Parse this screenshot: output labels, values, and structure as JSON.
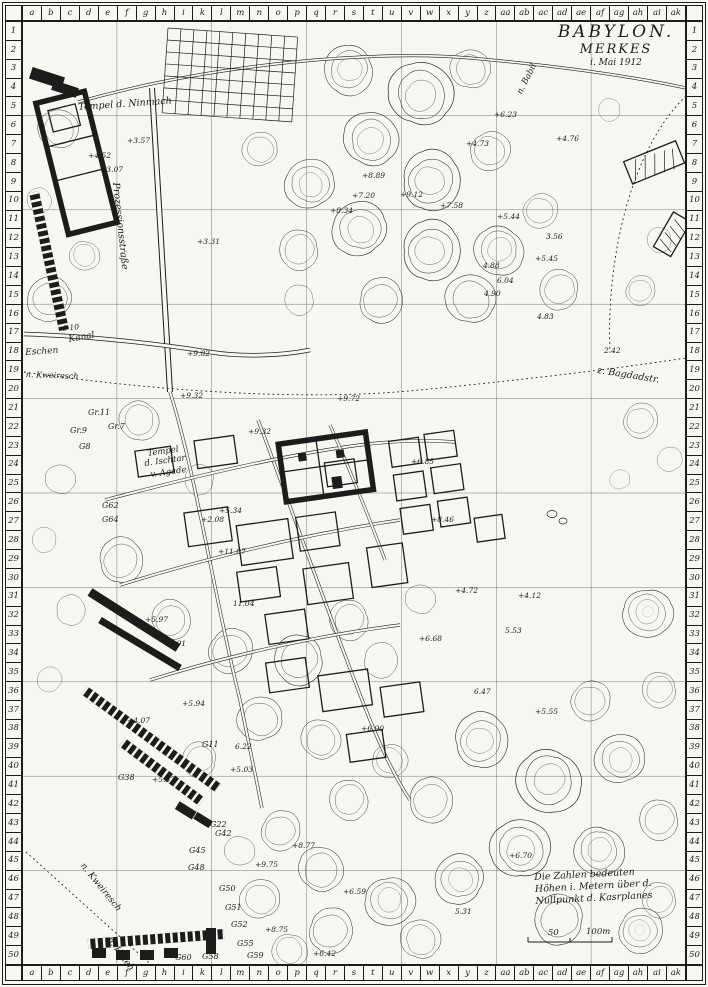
{
  "title": {
    "line1": "BABYLON.",
    "line2": "MERKES",
    "line3": "i. Mai 1912"
  },
  "legend": {
    "line1": "Die Zahlen bedeuten",
    "line2": "Höhen i. Metern über d.",
    "line3": "Nullpunkt d. Kasrplanes"
  },
  "scale": {
    "mid": "50",
    "end": "100m"
  },
  "grid": {
    "columns": [
      "a",
      "b",
      "c",
      "d",
      "e",
      "f",
      "g",
      "h",
      "i",
      "k",
      "l",
      "m",
      "n",
      "o",
      "p",
      "q",
      "r",
      "s",
      "t",
      "u",
      "v",
      "w",
      "x",
      "y",
      "z",
      "aa",
      "ab",
      "ac",
      "ad",
      "ae",
      "af",
      "ag",
      "ah",
      "ai",
      "ak"
    ],
    "rows": [
      "1",
      "2",
      "3",
      "4",
      "5",
      "6",
      "7",
      "8",
      "9",
      "10",
      "11",
      "12",
      "13",
      "14",
      "15",
      "16",
      "17",
      "18",
      "19",
      "20",
      "21",
      "22",
      "23",
      "24",
      "25",
      "26",
      "27",
      "28",
      "29",
      "30",
      "31",
      "32",
      "33",
      "34",
      "35",
      "36",
      "37",
      "38",
      "39",
      "40",
      "41",
      "42",
      "43",
      "44",
      "45",
      "46",
      "47",
      "48",
      "49",
      "50"
    ]
  },
  "map": {
    "labels": [
      {
        "text": "Tempel d. Ninmach",
        "x": 78,
        "y": 103,
        "rotate": -4,
        "size": 9.5
      },
      {
        "text": "Prozessionsstraße",
        "x": 120,
        "y": 182,
        "rotate": 84,
        "size": 9.5
      },
      {
        "text": "6·10",
        "x": 62,
        "y": 325,
        "rotate": -6,
        "size": 7.5
      },
      {
        "text": "Kanal",
        "x": 68,
        "y": 336,
        "rotate": -10,
        "size": 9
      },
      {
        "text": "Eschen",
        "x": 25,
        "y": 349,
        "rotate": -4,
        "size": 9
      },
      {
        "text": "n. Kweiresch",
        "x": 26,
        "y": 371,
        "rotate": 2,
        "size": 8
      },
      {
        "text": "Tempel",
        "x": 147,
        "y": 450,
        "rotate": -8,
        "size": 8.5
      },
      {
        "text": "d. Ischtar",
        "x": 144,
        "y": 460,
        "rotate": -8,
        "size": 8.5
      },
      {
        "text": "v. Agade",
        "x": 150,
        "y": 471,
        "rotate": -8,
        "size": 8.5
      },
      {
        "text": "z. Bagdadstr.",
        "x": 598,
        "y": 366,
        "rotate": 9,
        "size": 9.5
      },
      {
        "text": "n. Babil",
        "x": 516,
        "y": 92,
        "rotate": -63,
        "size": 8.5
      },
      {
        "text": "n. Kweiresch",
        "x": 85,
        "y": 862,
        "rotate": 51,
        "size": 9
      },
      {
        "text": "n. Hilleh",
        "x": 112,
        "y": 936,
        "rotate": 54,
        "size": 9
      }
    ],
    "spot_heights": [
      {
        "text": "+6.23",
        "x": 494,
        "y": 111
      },
      {
        "text": "+3.57",
        "x": 127,
        "y": 137
      },
      {
        "text": "+4.52",
        "x": 88,
        "y": 152
      },
      {
        "text": "+3.07",
        "x": 100,
        "y": 166
      },
      {
        "text": "+4.73",
        "x": 466,
        "y": 140
      },
      {
        "text": "+4.76",
        "x": 556,
        "y": 135
      },
      {
        "text": "+8.89",
        "x": 362,
        "y": 172
      },
      {
        "text": "+7.20",
        "x": 352,
        "y": 192
      },
      {
        "text": "+9.12",
        "x": 400,
        "y": 191
      },
      {
        "text": "+7.58",
        "x": 440,
        "y": 202
      },
      {
        "text": "+8.34",
        "x": 330,
        "y": 207
      },
      {
        "text": "+5.44",
        "x": 497,
        "y": 213
      },
      {
        "text": "+3.31",
        "x": 197,
        "y": 238
      },
      {
        "text": "3.56",
        "x": 546,
        "y": 233
      },
      {
        "text": "+5.45",
        "x": 535,
        "y": 255
      },
      {
        "text": "4.88",
        "x": 483,
        "y": 262
      },
      {
        "text": "6.04",
        "x": 497,
        "y": 277
      },
      {
        "text": "4.90",
        "x": 484,
        "y": 290
      },
      {
        "text": "4.83",
        "x": 537,
        "y": 313
      },
      {
        "text": "2.42",
        "x": 604,
        "y": 347
      },
      {
        "text": "+9.82",
        "x": 187,
        "y": 350
      },
      {
        "text": "+9.32",
        "x": 180,
        "y": 392
      },
      {
        "text": "+9.72",
        "x": 337,
        "y": 395
      },
      {
        "text": "+9.32",
        "x": 248,
        "y": 428
      },
      {
        "text": "+6.85",
        "x": 411,
        "y": 458
      },
      {
        "text": "+8.46",
        "x": 431,
        "y": 516
      },
      {
        "text": "+5.34",
        "x": 219,
        "y": 507
      },
      {
        "text": "+2.08",
        "x": 201,
        "y": 516
      },
      {
        "text": "+11.07",
        "x": 218,
        "y": 548
      },
      {
        "text": "11.04",
        "x": 233,
        "y": 600
      },
      {
        "text": "+5.97",
        "x": 145,
        "y": 616
      },
      {
        "text": "+6.91",
        "x": 163,
        "y": 640
      },
      {
        "text": "+4.72",
        "x": 455,
        "y": 587
      },
      {
        "text": "+4.12",
        "x": 518,
        "y": 592
      },
      {
        "text": "5.53",
        "x": 505,
        "y": 627
      },
      {
        "text": "+6.68",
        "x": 419,
        "y": 635
      },
      {
        "text": "6.47",
        "x": 474,
        "y": 688
      },
      {
        "text": "+5.55",
        "x": 535,
        "y": 708
      },
      {
        "text": "+6.90",
        "x": 361,
        "y": 725
      },
      {
        "text": "6.22",
        "x": 235,
        "y": 743
      },
      {
        "text": "+5.03",
        "x": 230,
        "y": 766
      },
      {
        "text": "+5.94",
        "x": 182,
        "y": 700
      },
      {
        "text": "+4.07",
        "x": 127,
        "y": 717
      },
      {
        "text": "+5.37",
        "x": 152,
        "y": 776
      },
      {
        "text": "+9.75",
        "x": 255,
        "y": 861
      },
      {
        "text": "+8.77",
        "x": 292,
        "y": 842
      },
      {
        "text": "+8.75",
        "x": 265,
        "y": 926
      },
      {
        "text": "+6.59",
        "x": 343,
        "y": 888
      },
      {
        "text": "5.31",
        "x": 455,
        "y": 908
      },
      {
        "text": "+6.70",
        "x": 509,
        "y": 852
      },
      {
        "text": "+6.42",
        "x": 313,
        "y": 950
      }
    ],
    "excavation_labels": [
      {
        "text": "Gr.11",
        "x": 88,
        "y": 409
      },
      {
        "text": "Gr.9",
        "x": 70,
        "y": 427
      },
      {
        "text": "Gr.7",
        "x": 108,
        "y": 423
      },
      {
        "text": "G8",
        "x": 79,
        "y": 443
      },
      {
        "text": "G62",
        "x": 102,
        "y": 502
      },
      {
        "text": "G64",
        "x": 102,
        "y": 516
      },
      {
        "text": "G11",
        "x": 202,
        "y": 741
      },
      {
        "text": "G38",
        "x": 118,
        "y": 774
      },
      {
        "text": "G22",
        "x": 210,
        "y": 821
      },
      {
        "text": "G42",
        "x": 215,
        "y": 830
      },
      {
        "text": "G45",
        "x": 189,
        "y": 847
      },
      {
        "text": "G48",
        "x": 188,
        "y": 864
      },
      {
        "text": "G50",
        "x": 219,
        "y": 885
      },
      {
        "text": "G51",
        "x": 225,
        "y": 904
      },
      {
        "text": "G52",
        "x": 231,
        "y": 921
      },
      {
        "text": "G55",
        "x": 237,
        "y": 940
      },
      {
        "text": "G58",
        "x": 202,
        "y": 953
      },
      {
        "text": "G59",
        "x": 247,
        "y": 952
      },
      {
        "text": "G60",
        "x": 175,
        "y": 954
      }
    ]
  }
}
